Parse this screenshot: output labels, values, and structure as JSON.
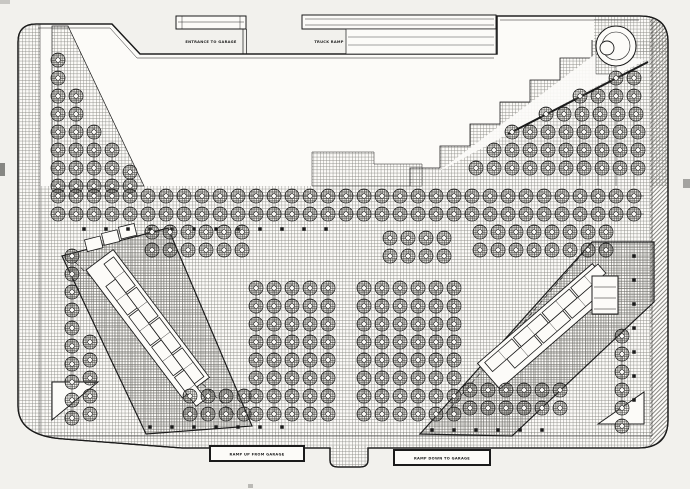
{
  "plan": {
    "labels": {
      "entrance_to_garage": "ENTRANCE TO GARAGE",
      "truck_ramp": "TRUCK RAMP",
      "ramp_up_from_garage": "RAMP UP FROM GARAGE",
      "ramp_down_to_garage": "RAMP DOWN TO GARAGE"
    },
    "colors": {
      "ink": "#1b1b1b",
      "paper": "#f2f1ed",
      "drawing_white": "#fcfbf8",
      "paving_hatch": "#8a8a85",
      "court_hatch": "#6e6d68",
      "tree_hatch": "#474641"
    }
  }
}
